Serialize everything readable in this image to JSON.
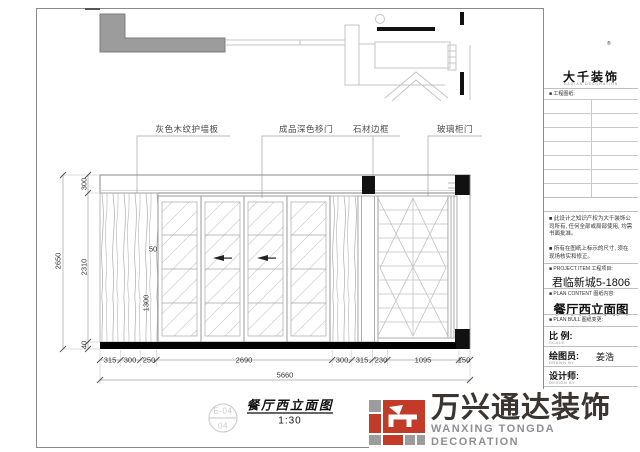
{
  "page": {
    "sheet_title": "餐厅西立面图",
    "scale": "1:30",
    "detail_ref_top": "E-04",
    "detail_ref_bottom": "04"
  },
  "callouts": [
    "灰色木纹护墙板",
    "成品深色移门",
    "石材边框",
    "玻璃柜门"
  ],
  "dims": {
    "left_total": "2650",
    "left": [
      "300",
      "2310",
      "40"
    ],
    "inner": [
      "50",
      "1300"
    ],
    "bottom": [
      "315",
      "300",
      "250",
      "2690",
      "300",
      "315",
      "230",
      "1095",
      "150"
    ],
    "bottom_total": "5660"
  },
  "title_block": {
    "brand_seal": "大千",
    "brand_reg": "®",
    "brand_name": "大千装饰",
    "brand_sub": "DAQIAN DECORATION",
    "drawing_list_label": "■ 工程图纸:",
    "note1": "■ 此设计之知识产权为大千装饰公司所有, 任何全部或局部使用, 均需书面批准。",
    "note2": "■ 所有在图纸上标示的尺寸, 须在现场核实和修正。",
    "project_label": "■ PROJECT ITEM  工程项目:",
    "project_value": "君临新城5-1806",
    "content_label": "■ PLAN CONTENT  图纸内容:",
    "content_value": "餐厅西立面图",
    "change_label": "■ PLAN BULL  图纸变更:",
    "fields": [
      {
        "label": "比  例:",
        "sub": "SCALE",
        "value": ""
      },
      {
        "label": "绘图员:",
        "sub": "DRAWN  BY",
        "value": "姜浩"
      },
      {
        "label": "设计师:",
        "sub": "DESIGN  BY",
        "value": ""
      },
      {
        "label": "审  核:",
        "sub": "APPROVED  BY",
        "value": ""
      },
      {
        "label": "业主签字:",
        "sub": "",
        "value": ""
      }
    ]
  },
  "footer_logo": {
    "name": "万兴通达装饰",
    "name_en": "WANXING TONGDA DECORATION"
  },
  "colors": {
    "accent_red": "#c23b28",
    "logo_gray": "#9c9c9c",
    "ink": "#3b3531",
    "line_light": "#bdbdbd"
  }
}
